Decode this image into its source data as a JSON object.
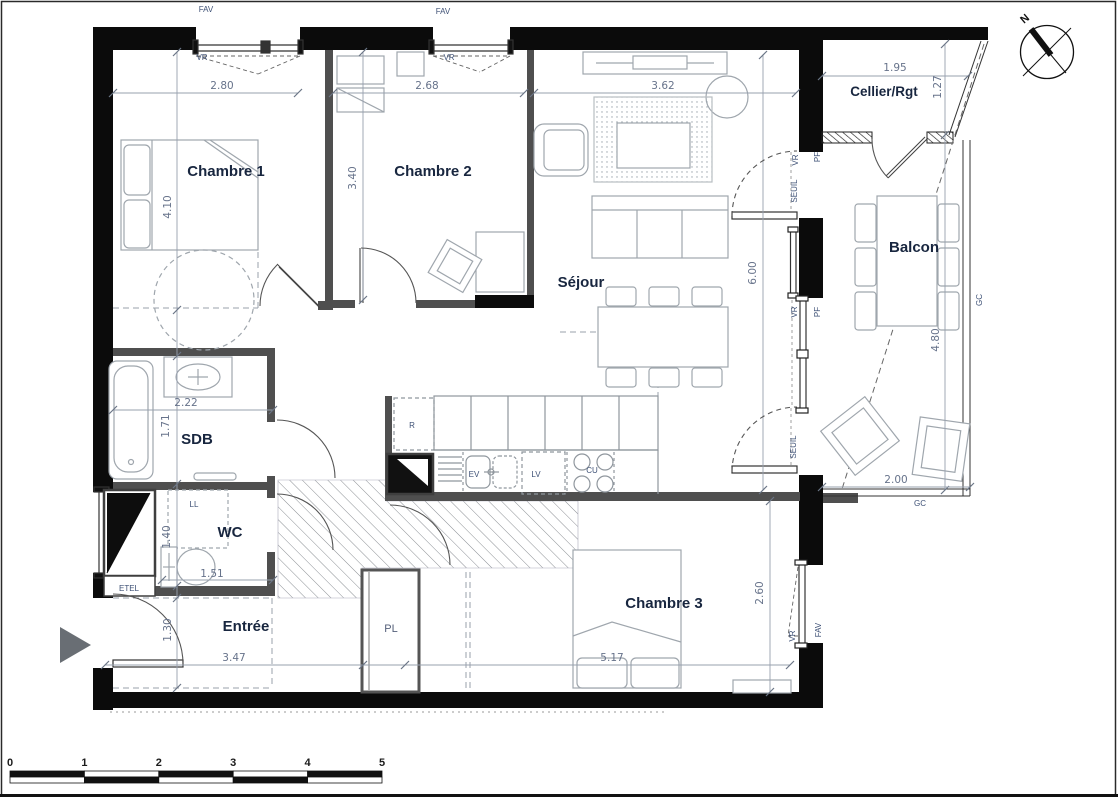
{
  "plan": {
    "type": "floor-plan-apartment",
    "rooms": [
      {
        "id": "chambre-1",
        "label": "Chambre 1",
        "x": 226,
        "y": 176
      },
      {
        "id": "chambre-2",
        "label": "Chambre 2",
        "x": 433,
        "y": 176
      },
      {
        "id": "sejour",
        "label": "Séjour",
        "x": 581,
        "y": 287
      },
      {
        "id": "cellier",
        "label": "Cellier/Rgt",
        "x": 884,
        "y": 96,
        "small": true
      },
      {
        "id": "balcon",
        "label": "Balcon",
        "x": 914,
        "y": 252
      },
      {
        "id": "sdb",
        "label": "SDB",
        "x": 197,
        "y": 444
      },
      {
        "id": "wc",
        "label": "WC",
        "x": 230,
        "y": 537
      },
      {
        "id": "entree",
        "label": "Entrée",
        "x": 246,
        "y": 631
      },
      {
        "id": "chambre-3",
        "label": "Chambre 3",
        "x": 664,
        "y": 608
      }
    ],
    "annotations": [
      {
        "t": "FAV",
        "x": 206,
        "y": 12
      },
      {
        "t": "VR",
        "x": 202,
        "y": 60
      },
      {
        "t": "FAV",
        "x": 443,
        "y": 14
      },
      {
        "t": "VR",
        "x": 449,
        "y": 60
      },
      {
        "t": "VR",
        "x": 798,
        "y": 160,
        "rot": -90
      },
      {
        "t": "PF",
        "x": 820,
        "y": 157,
        "rot": -90
      },
      {
        "t": "SEUIL",
        "x": 797,
        "y": 191,
        "rot": -90
      },
      {
        "t": "VR",
        "x": 797,
        "y": 312,
        "rot": -90
      },
      {
        "t": "PF",
        "x": 820,
        "y": 312,
        "rot": -90
      },
      {
        "t": "SEUIL",
        "x": 796,
        "y": 447,
        "rot": -90
      },
      {
        "t": "VR",
        "x": 795,
        "y": 636,
        "rot": -90
      },
      {
        "t": "FAV",
        "x": 821,
        "y": 630,
        "rot": -90
      },
      {
        "t": "GC",
        "x": 982,
        "y": 300,
        "rot": -90
      },
      {
        "t": "GC",
        "x": 920,
        "y": 506
      },
      {
        "t": "PL",
        "x": 391,
        "y": 632,
        "big": true
      },
      {
        "t": "R",
        "x": 412,
        "y": 428
      },
      {
        "t": "EV",
        "x": 474,
        "y": 477
      },
      {
        "t": "LV",
        "x": 536,
        "y": 477
      },
      {
        "t": "CU",
        "x": 592,
        "y": 473
      },
      {
        "t": "LL",
        "x": 194,
        "y": 507
      },
      {
        "t": "ETEL",
        "x": 129,
        "y": 591
      }
    ],
    "dimensions": [
      {
        "t": "2.80",
        "x": 222,
        "y": 89
      },
      {
        "t": "2.68",
        "x": 427,
        "y": 89
      },
      {
        "t": "3.62",
        "x": 663,
        "y": 89
      },
      {
        "t": "1.95",
        "x": 895,
        "y": 71
      },
      {
        "t": "1.27",
        "x": 941,
        "y": 87,
        "rot": -90
      },
      {
        "t": "4.10",
        "x": 171,
        "y": 207,
        "rot": -90
      },
      {
        "t": "3.40",
        "x": 356,
        "y": 178,
        "rot": -90
      },
      {
        "t": "6.00",
        "x": 756,
        "y": 273,
        "rot": -90
      },
      {
        "t": "4.80",
        "x": 939,
        "y": 340,
        "rot": -90
      },
      {
        "t": "2.22",
        "x": 186,
        "y": 406
      },
      {
        "t": "1.71",
        "x": 169,
        "y": 426,
        "rot": -90
      },
      {
        "t": "1.40",
        "x": 170,
        "y": 537,
        "rot": -90
      },
      {
        "t": "1.51",
        "x": 212,
        "y": 577
      },
      {
        "t": "1.30",
        "x": 171,
        "y": 630,
        "rot": -90
      },
      {
        "t": "3.47",
        "x": 234,
        "y": 661
      },
      {
        "t": "5.17",
        "x": 612,
        "y": 661
      },
      {
        "t": "2.00",
        "x": 896,
        "y": 483
      },
      {
        "t": "2.60",
        "x": 763,
        "y": 593,
        "rot": -90
      }
    ],
    "compass": {
      "label": "N"
    },
    "scale_bar": {
      "ticks": [
        "0",
        "1",
        "2",
        "3",
        "4",
        "5"
      ],
      "x0": 10,
      "y0": 771,
      "seg": 74.4
    }
  }
}
